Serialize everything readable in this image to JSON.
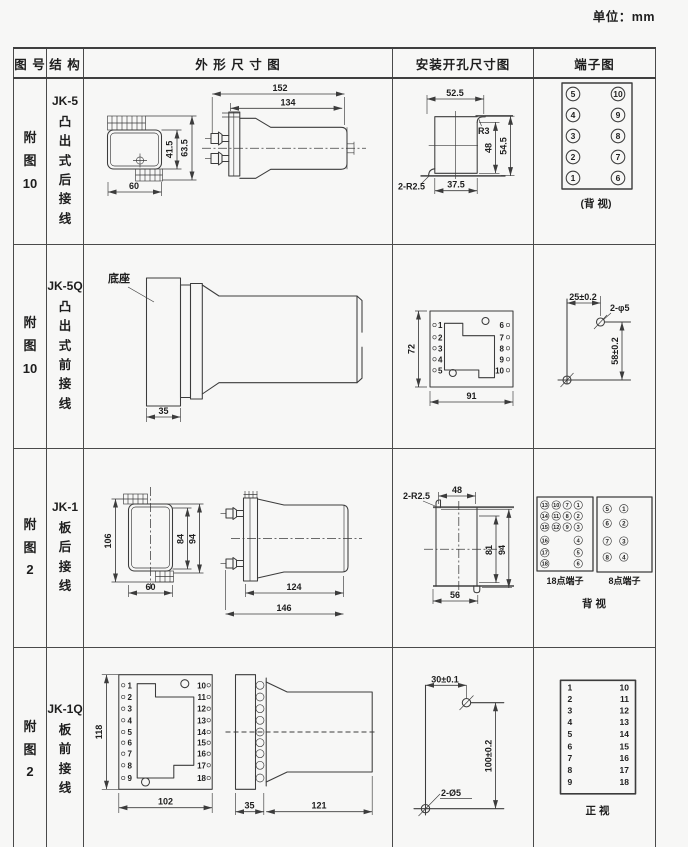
{
  "unit_label": "单位：mm",
  "header": {
    "fig": "图 号",
    "struct": "结 构",
    "outline": "外 形 尺 寸 图",
    "mounting": "安装开孔尺寸图",
    "terminal": "端子图"
  },
  "rows": [
    {
      "fig": "附\n图\n10",
      "model": "JK-5",
      "struct": "凸\n出\n式\n后\n接\n线",
      "outline": {
        "d152": "152",
        "d134": "134",
        "d41_5": "41.5",
        "d63_5": "63.5",
        "d60": "60"
      },
      "mounting": {
        "d52_5": "52.5",
        "r3": "R3",
        "d48": "48",
        "d54_5": "54.5",
        "r2_5": "2-R2.5",
        "d37_5": "37.5"
      },
      "terminal": {
        "left": [
          "5",
          "4",
          "3",
          "2",
          "1"
        ],
        "right": [
          "10",
          "9",
          "8",
          "7",
          "6"
        ],
        "caption": "(背 视)"
      }
    },
    {
      "fig": "附\n图\n10",
      "model": "JK-5Q",
      "struct": "凸\n出\n式\n前\n接\n线",
      "outline": {
        "base_label": "底座",
        "d35": "35"
      },
      "mounting": {
        "d72": "72",
        "d91": "91",
        "left": [
          "1",
          "2",
          "3",
          "4",
          "5"
        ],
        "right": [
          "6",
          "7",
          "8",
          "9",
          "10"
        ]
      },
      "terminal": {
        "d25": "25±0.2",
        "dphi": "2-φ5",
        "d58": "58±0.2"
      }
    },
    {
      "fig": "附\n图\n2",
      "model": "JK-1",
      "struct": "板\n后\n接\n线",
      "outline": {
        "d106": "106",
        "d84": "84",
        "d94": "94",
        "d60": "60",
        "d124": "124",
        "d146": "146"
      },
      "mounting": {
        "r2_5": "2-R2.5",
        "d48": "48",
        "d81": "81",
        "d94": "94",
        "d56": "56"
      },
      "terminal": {
        "t18": {
          "c1": [
            "13",
            "14",
            "15",
            "16",
            "17",
            "18"
          ],
          "c2": [
            "10",
            "11",
            "12"
          ],
          "c3": [
            "7",
            "8",
            "9"
          ],
          "c4": [
            "1",
            "2",
            "3",
            "4",
            "5",
            "6"
          ],
          "label": "18点端子"
        },
        "t8": {
          "left": [
            "5",
            "6",
            "7",
            "8"
          ],
          "right": [
            "1",
            "2",
            "3",
            "4"
          ],
          "label": "8点端子"
        },
        "caption": "背  视"
      }
    },
    {
      "fig": "附\n图\n2",
      "model": "JK-1Q",
      "struct": "板\n前\n接\n线",
      "outline": {
        "d118": "118",
        "d102": "102",
        "d35": "35",
        "d121": "121",
        "left": [
          "1",
          "2",
          "3",
          "4",
          "5",
          "6",
          "7",
          "8",
          "9"
        ],
        "right": [
          "10",
          "11",
          "12",
          "13",
          "14",
          "15",
          "16",
          "17",
          "18"
        ]
      },
      "mounting": {
        "d30": "30±0.1",
        "d100": "100±0.2",
        "dphi": "2-Ø5"
      },
      "terminal": {
        "left": [
          "1",
          "2",
          "3",
          "4",
          "5",
          "6",
          "7",
          "8",
          "9"
        ],
        "right": [
          "10",
          "11",
          "12",
          "13",
          "14",
          "15",
          "16",
          "17",
          "18"
        ],
        "caption": "正  视"
      }
    }
  ]
}
